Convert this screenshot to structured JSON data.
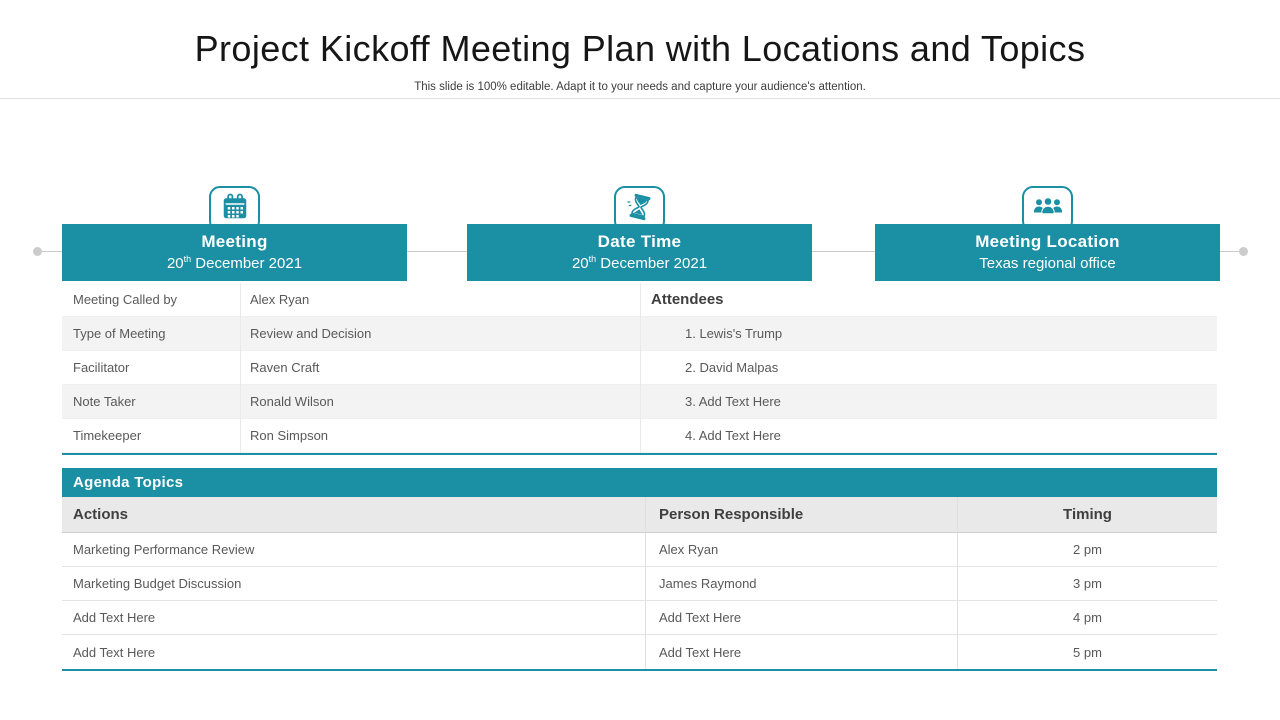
{
  "slide": {
    "title": "Project Kickoff Meeting Plan with Locations and Topics",
    "subtitle": "This slide is 100% editable. Adapt it to your needs and capture your audience's attention."
  },
  "colors": {
    "teal": "#1b8fa4",
    "stripe": "#f3f3f3",
    "header_gray": "#e9e9e9",
    "line_gray": "#e2e2e2",
    "connector_gray": "#cccccc"
  },
  "cards": [
    {
      "icon": "calendar-icon",
      "title": "Meeting",
      "line2_pre": "20",
      "line2_sup": "th",
      "line2_post": " December 2021"
    },
    {
      "icon": "hourglass-icon",
      "title": "Date Time",
      "line2_pre": "20",
      "line2_sup": "th",
      "line2_post": " December 2021"
    },
    {
      "icon": "people-icon",
      "title": "Meeting Location",
      "line2_pre": "Texas regional office",
      "line2_sup": "",
      "line2_post": ""
    }
  ],
  "details": {
    "rows": [
      {
        "label": "Meeting Called by",
        "value": "Alex Ryan"
      },
      {
        "label": "Type of Meeting",
        "value": "Review and Decision"
      },
      {
        "label": "Facilitator",
        "value": "Raven Craft"
      },
      {
        "label": "Note Taker",
        "value": "Ronald Wilson"
      },
      {
        "label": "Timekeeper",
        "value": "Ron Simpson"
      }
    ]
  },
  "attendees": {
    "header": "Attendees",
    "items": [
      "1. Lewis's Trump",
      "2. David Malpas",
      "3. Add Text Here",
      "4. Add Text Here"
    ]
  },
  "agenda": {
    "section_title": "Agenda Topics",
    "columns": [
      "Actions",
      "Person Responsible",
      "Timing"
    ],
    "rows": [
      {
        "action": "Marketing Performance Review",
        "person": "Alex Ryan",
        "timing": "2 pm"
      },
      {
        "action": "Marketing Budget Discussion",
        "person": "James Raymond",
        "timing": "3 pm"
      },
      {
        "action": "Add Text Here",
        "person": "Add Text Here",
        "timing": "4 pm"
      },
      {
        "action": "Add Text Here",
        "person": "Add Text Here",
        "timing": "5 pm"
      }
    ]
  }
}
